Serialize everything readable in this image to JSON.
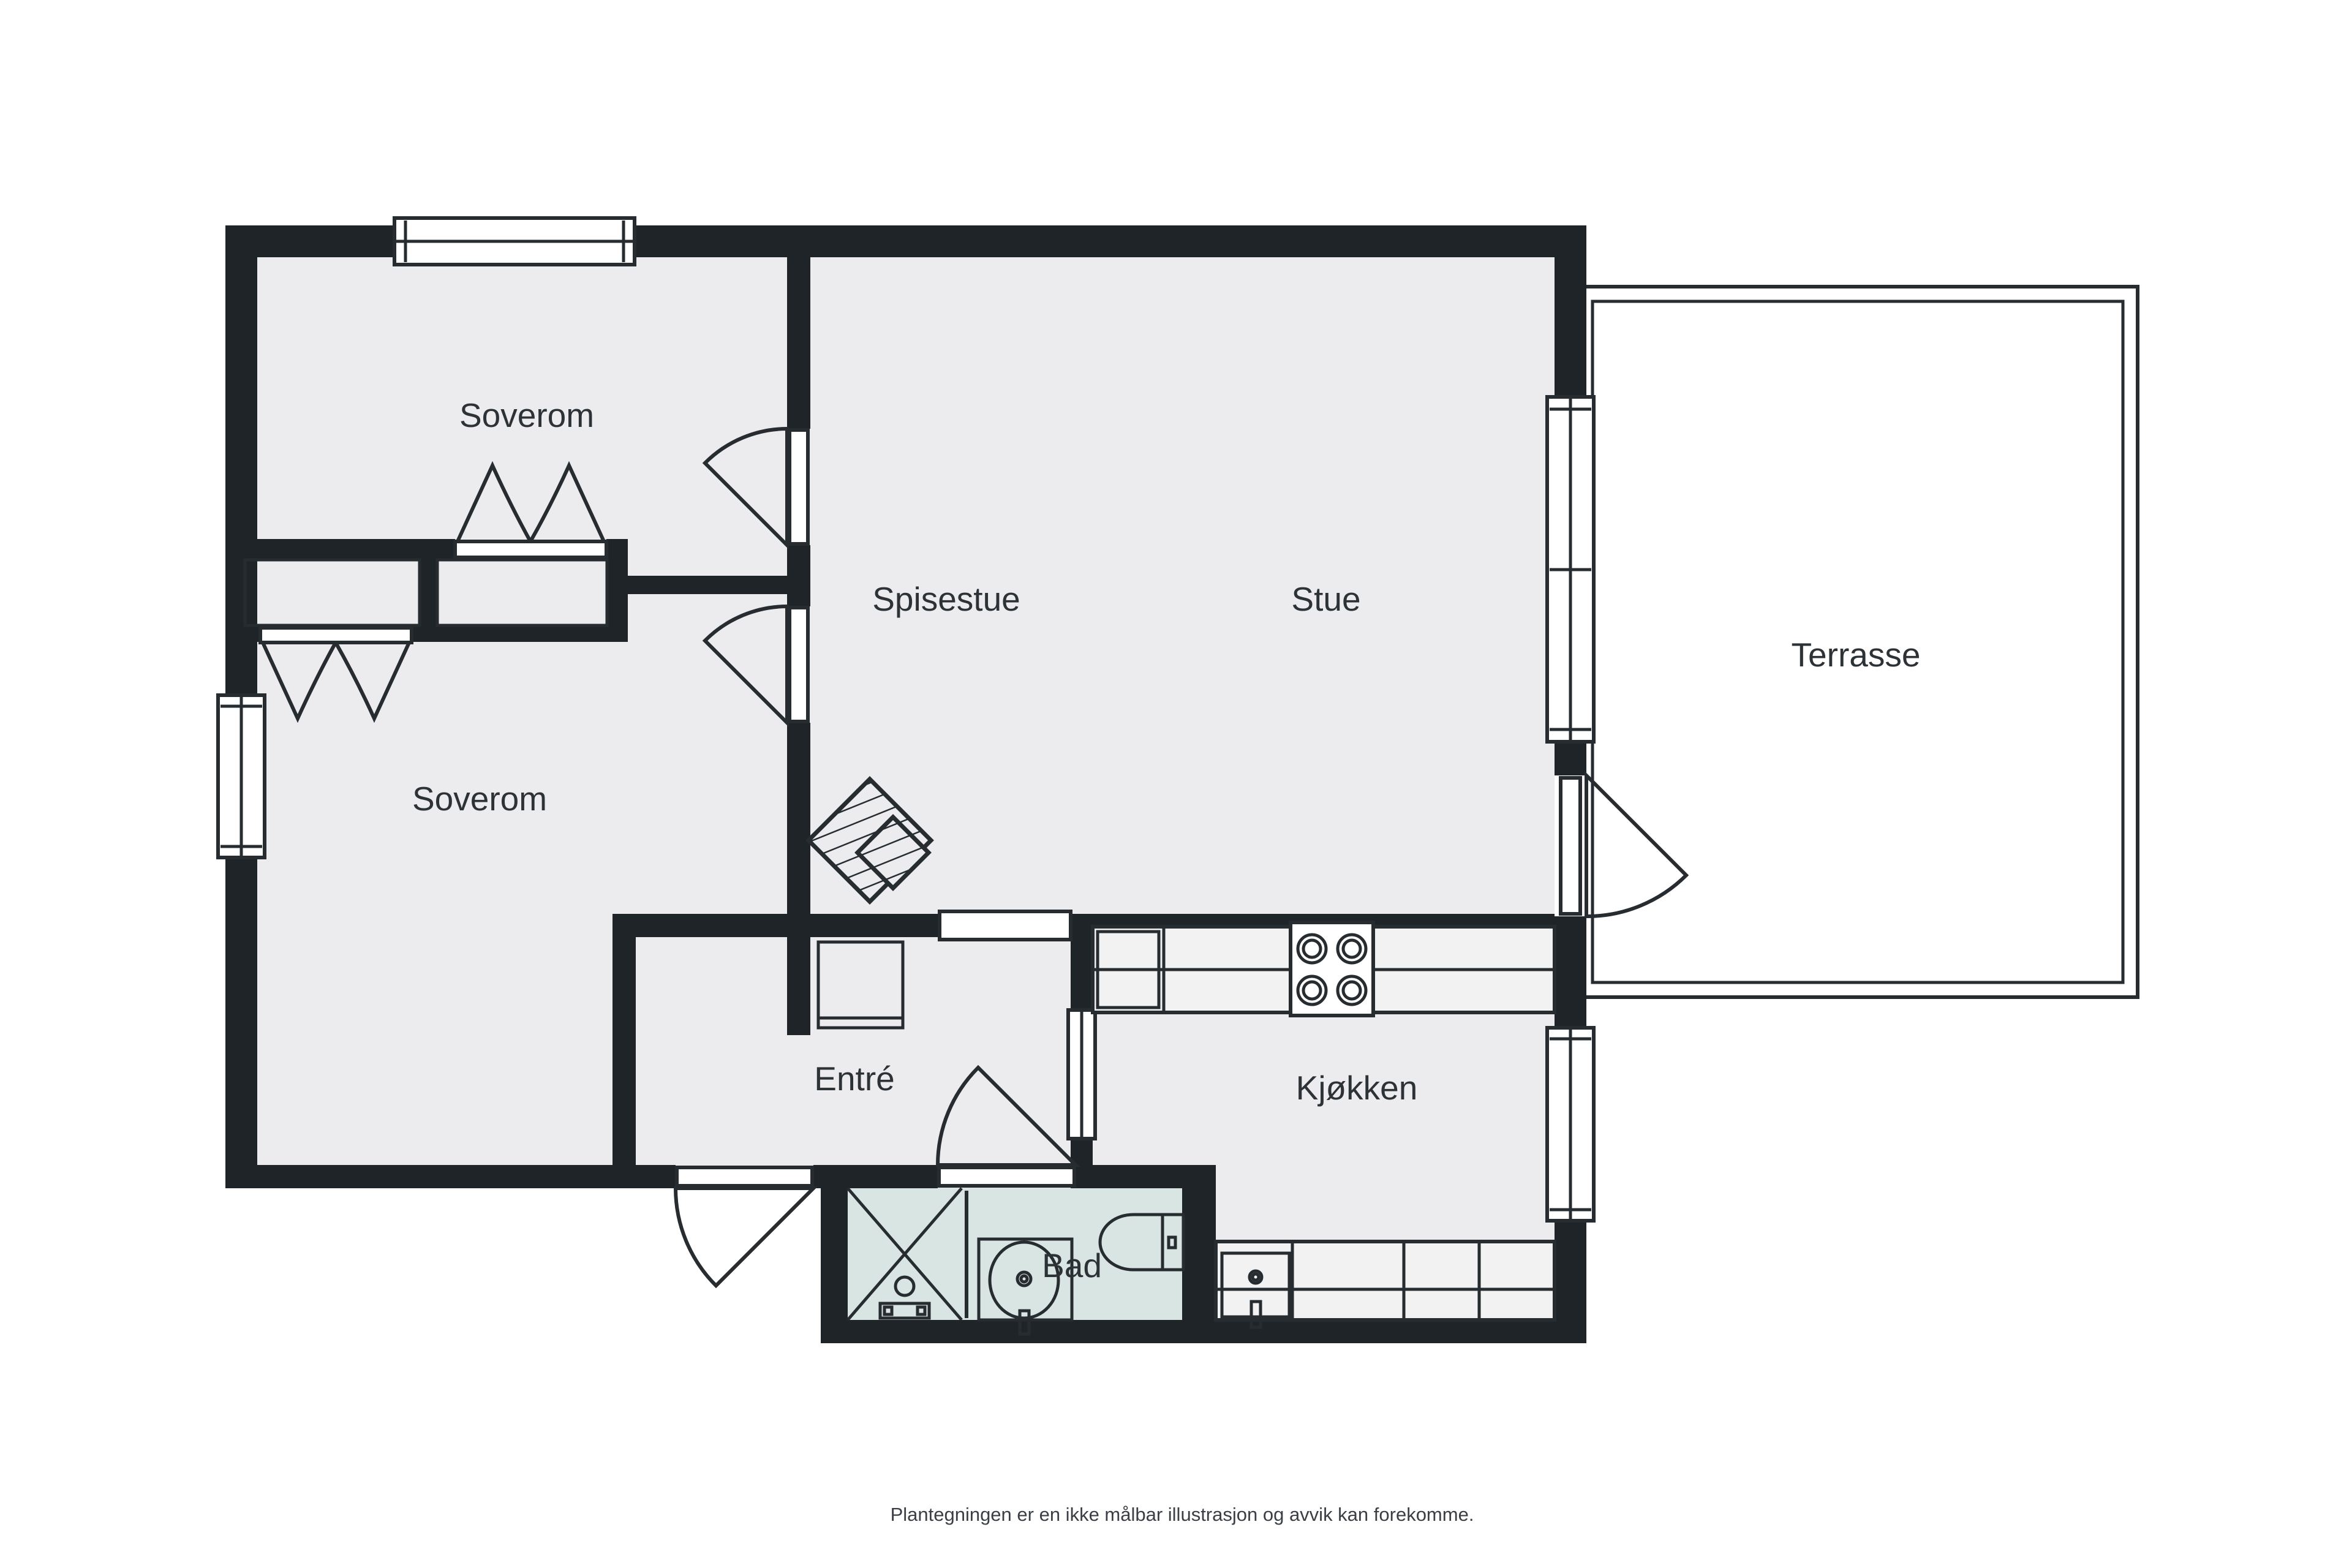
{
  "document_type": "floor-plan",
  "rooms": [
    {
      "id": "soverom-1",
      "label": "Soverom"
    },
    {
      "id": "spisestue",
      "label": "Spisestue"
    },
    {
      "id": "stue",
      "label": "Stue"
    },
    {
      "id": "terrasse",
      "label": "Terrasse"
    },
    {
      "id": "soverom-2",
      "label": "Soverom"
    },
    {
      "id": "entre",
      "label": "Entré"
    },
    {
      "id": "kjokken",
      "label": "Kjøkken"
    },
    {
      "id": "bad",
      "label": "Bad"
    }
  ],
  "disclaimer": "Plantegningen er en ikke målbar illustrasjon og avvik kan forekomme.",
  "fixtures": [
    "stove-icon",
    "fridge-icon",
    "kitchen-sink-icon",
    "kitchen-counter",
    "shower-icon",
    "bathroom-sink-icon",
    "toilet-icon",
    "fireplace-icon",
    "wardrobe-icon",
    "cabinet-icon"
  ],
  "colors": {
    "background": "#ffffff",
    "wall": "#1f2429",
    "floor": "#ececee",
    "bathroom_floor": "#d8e5e3",
    "line": "#272c31",
    "text": "#2d3237"
  }
}
